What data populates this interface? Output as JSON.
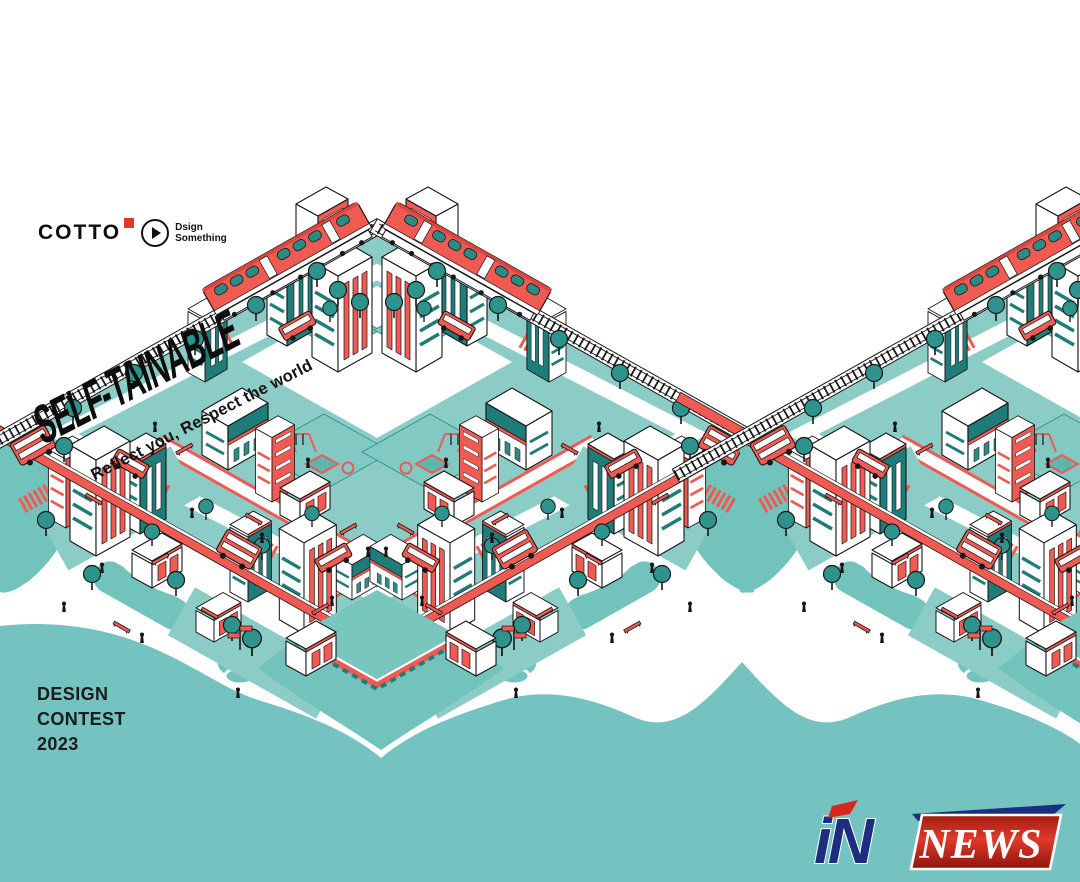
{
  "branding": {
    "cotto_label": "COTTO",
    "dsign_line1": "Dsign",
    "dsign_line2": "Something"
  },
  "hero": {
    "title": "SELF-TAINABLE",
    "tagline": "Reflect you, Respect the world"
  },
  "contest": {
    "lines": [
      "DESIGN",
      "CONTEST",
      "2023"
    ]
  },
  "watermark": {
    "prefix": "iN",
    "word": "NEWS"
  },
  "colors": {
    "sea_teal": "#74C3C1",
    "platform_teal": "#8CCCC6",
    "grass_teal": "#72C3BC",
    "tree_teal": "#2F938D",
    "building_dark_teal": "#1F7C78",
    "accent_red": "#EF5A52",
    "cotto_red": "#E0382C",
    "news_red": "#C4281C",
    "news_navy": "#1C2E7E",
    "ink": "#171717"
  }
}
